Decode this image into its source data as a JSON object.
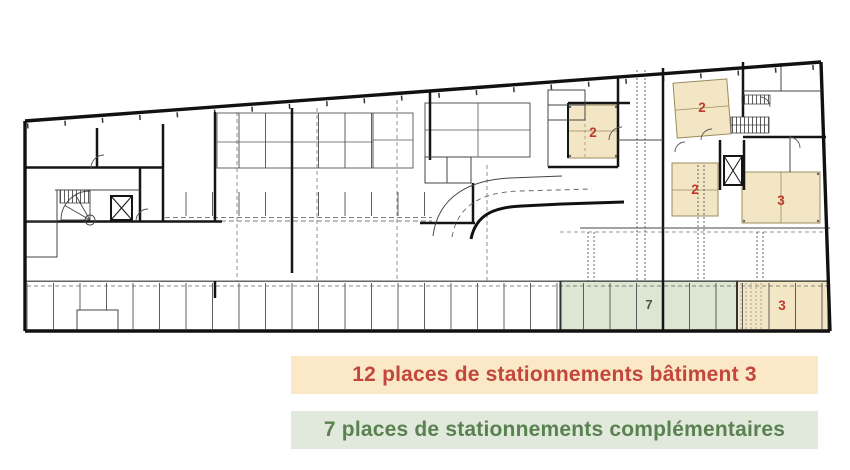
{
  "legend": {
    "items": [
      {
        "label": "12 places de stationnements bâtiment 3",
        "text_color": "#c2463c",
        "bg_color": "#fbe8c6"
      },
      {
        "label": "7 places de stationnements complémentaires",
        "text_color": "#5a8150",
        "bg_color": "#e1e9dc"
      }
    ]
  },
  "plan": {
    "colors": {
      "batiment3_highlight": "#f2e6c4",
      "complementaire_highlight": "#dbe7d2",
      "marker_red": "#c0392b",
      "marker_dark": "#4b5248"
    },
    "markers": [
      {
        "label": "2"
      },
      {
        "label": "2"
      },
      {
        "label": "2"
      },
      {
        "label": "3"
      },
      {
        "label": "3"
      },
      {
        "label": "7"
      }
    ]
  }
}
